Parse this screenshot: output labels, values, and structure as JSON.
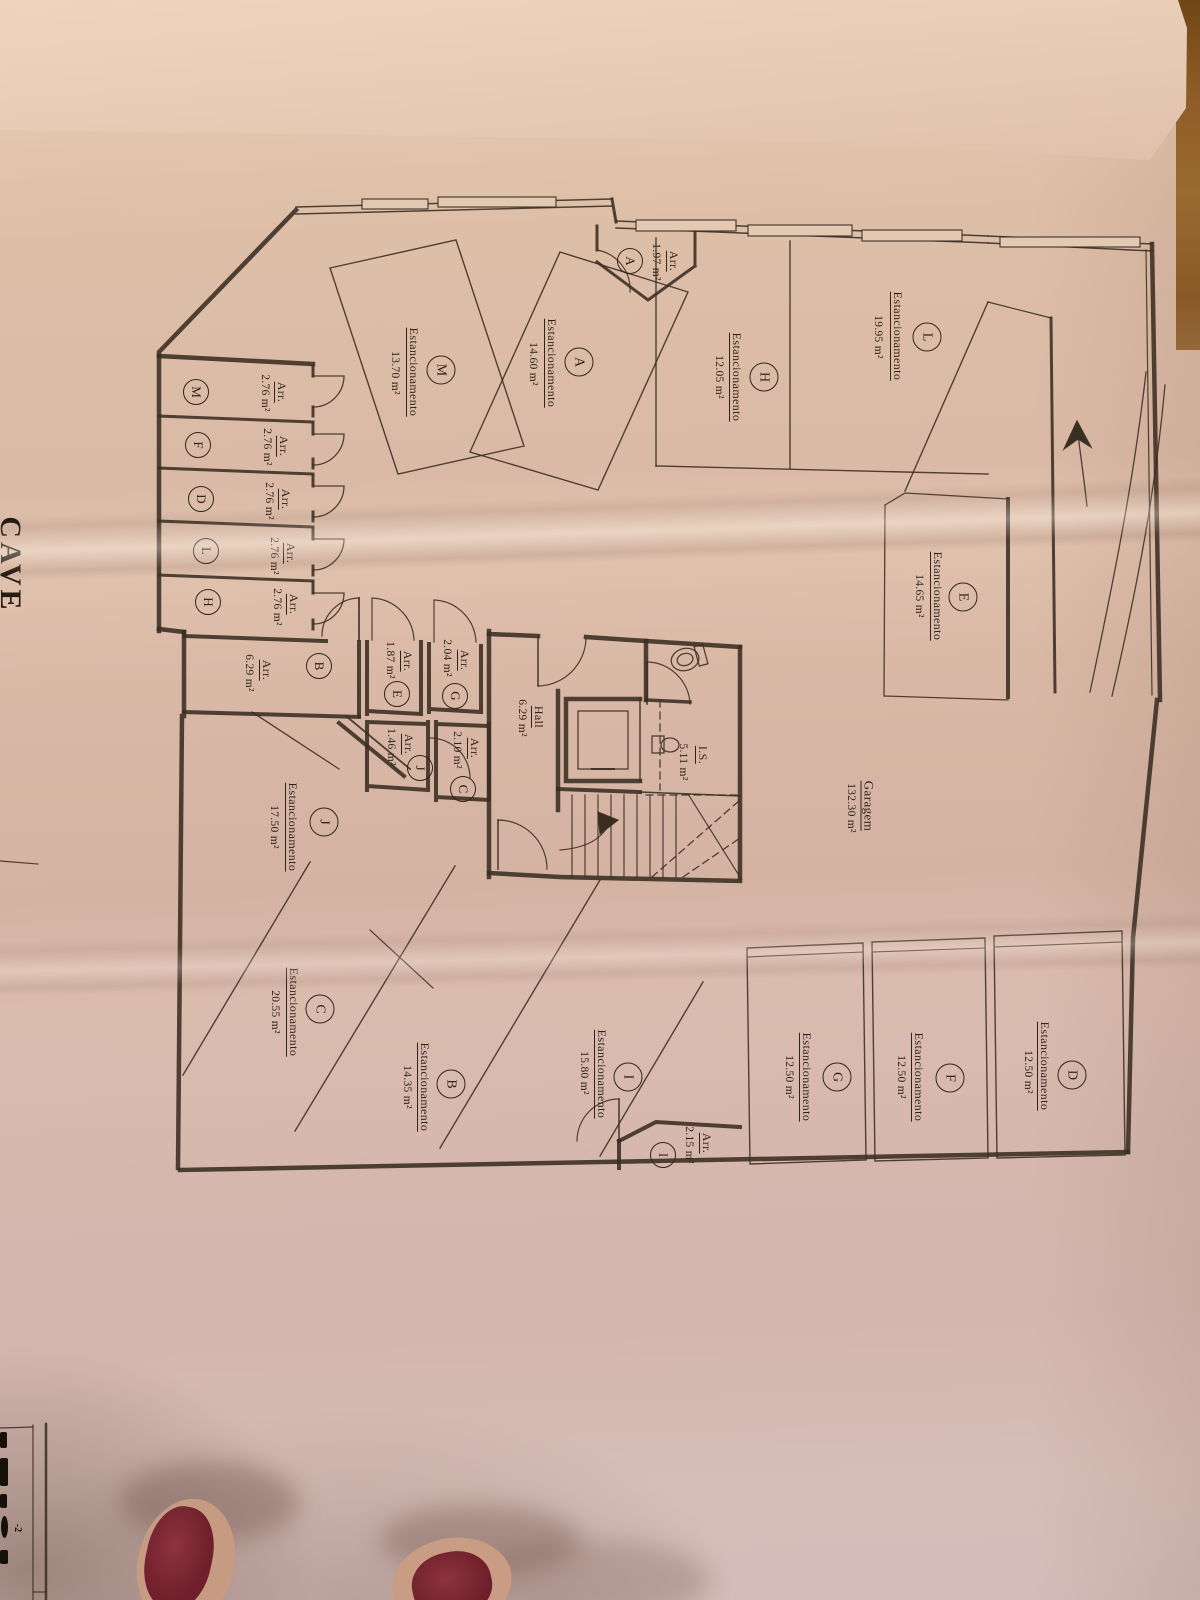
{
  "photo": {
    "sheet_title": "CAVE",
    "title_block_fragment": "-2"
  },
  "legend": {
    "parking_label": "Estancionamento",
    "storage_label": "Arr.",
    "colors": {
      "paper": "#dcbfa9",
      "ink": "#3a2d22",
      "wood": "#9a6a33",
      "nail_polish": "#7d2733"
    }
  },
  "garage": {
    "name": "Garagem",
    "area": "132.30 m²"
  },
  "hall": {
    "name": "Hall",
    "area": "6.29 m²"
  },
  "wc": {
    "name": "I.S.",
    "area": "5.11 m²"
  },
  "parking_spaces": [
    {
      "letter": "L",
      "area": "19.95 m²"
    },
    {
      "letter": "H",
      "area": "12.05 m²"
    },
    {
      "letter": "A",
      "area": "14.60 m²"
    },
    {
      "letter": "M",
      "area": "13.70 m²"
    },
    {
      "letter": "E",
      "area": "14.65 m²"
    },
    {
      "letter": "J",
      "area": "17.50 m²"
    },
    {
      "letter": "C",
      "area": "20.55 m²"
    },
    {
      "letter": "B",
      "area": "14.35 m²"
    },
    {
      "letter": "I",
      "area": "15.80 m²"
    },
    {
      "letter": "G",
      "area": "12.50 m²"
    },
    {
      "letter": "F",
      "area": "12.50 m²"
    },
    {
      "letter": "D",
      "area": "12.50 m²"
    }
  ],
  "storage_rooms": [
    {
      "letter": "A",
      "area": "1.97 m²"
    },
    {
      "letter": "M",
      "area": "2.76 m²"
    },
    {
      "letter": "F",
      "area": "2.76 m²"
    },
    {
      "letter": "D",
      "area": "2.76 m²"
    },
    {
      "letter": "L",
      "area": "2.76 m²"
    },
    {
      "letter": "H",
      "area": "2.76 m²"
    },
    {
      "letter": "B",
      "area": "6.29 m²"
    },
    {
      "letter": "E",
      "area": "1.87 m²"
    },
    {
      "letter": "G",
      "area": "2.04 m²"
    },
    {
      "letter": "J",
      "area": "1.46 m²"
    },
    {
      "letter": "C",
      "area": "2.10 m²"
    },
    {
      "letter": "I",
      "area": "2.15 m²"
    }
  ]
}
